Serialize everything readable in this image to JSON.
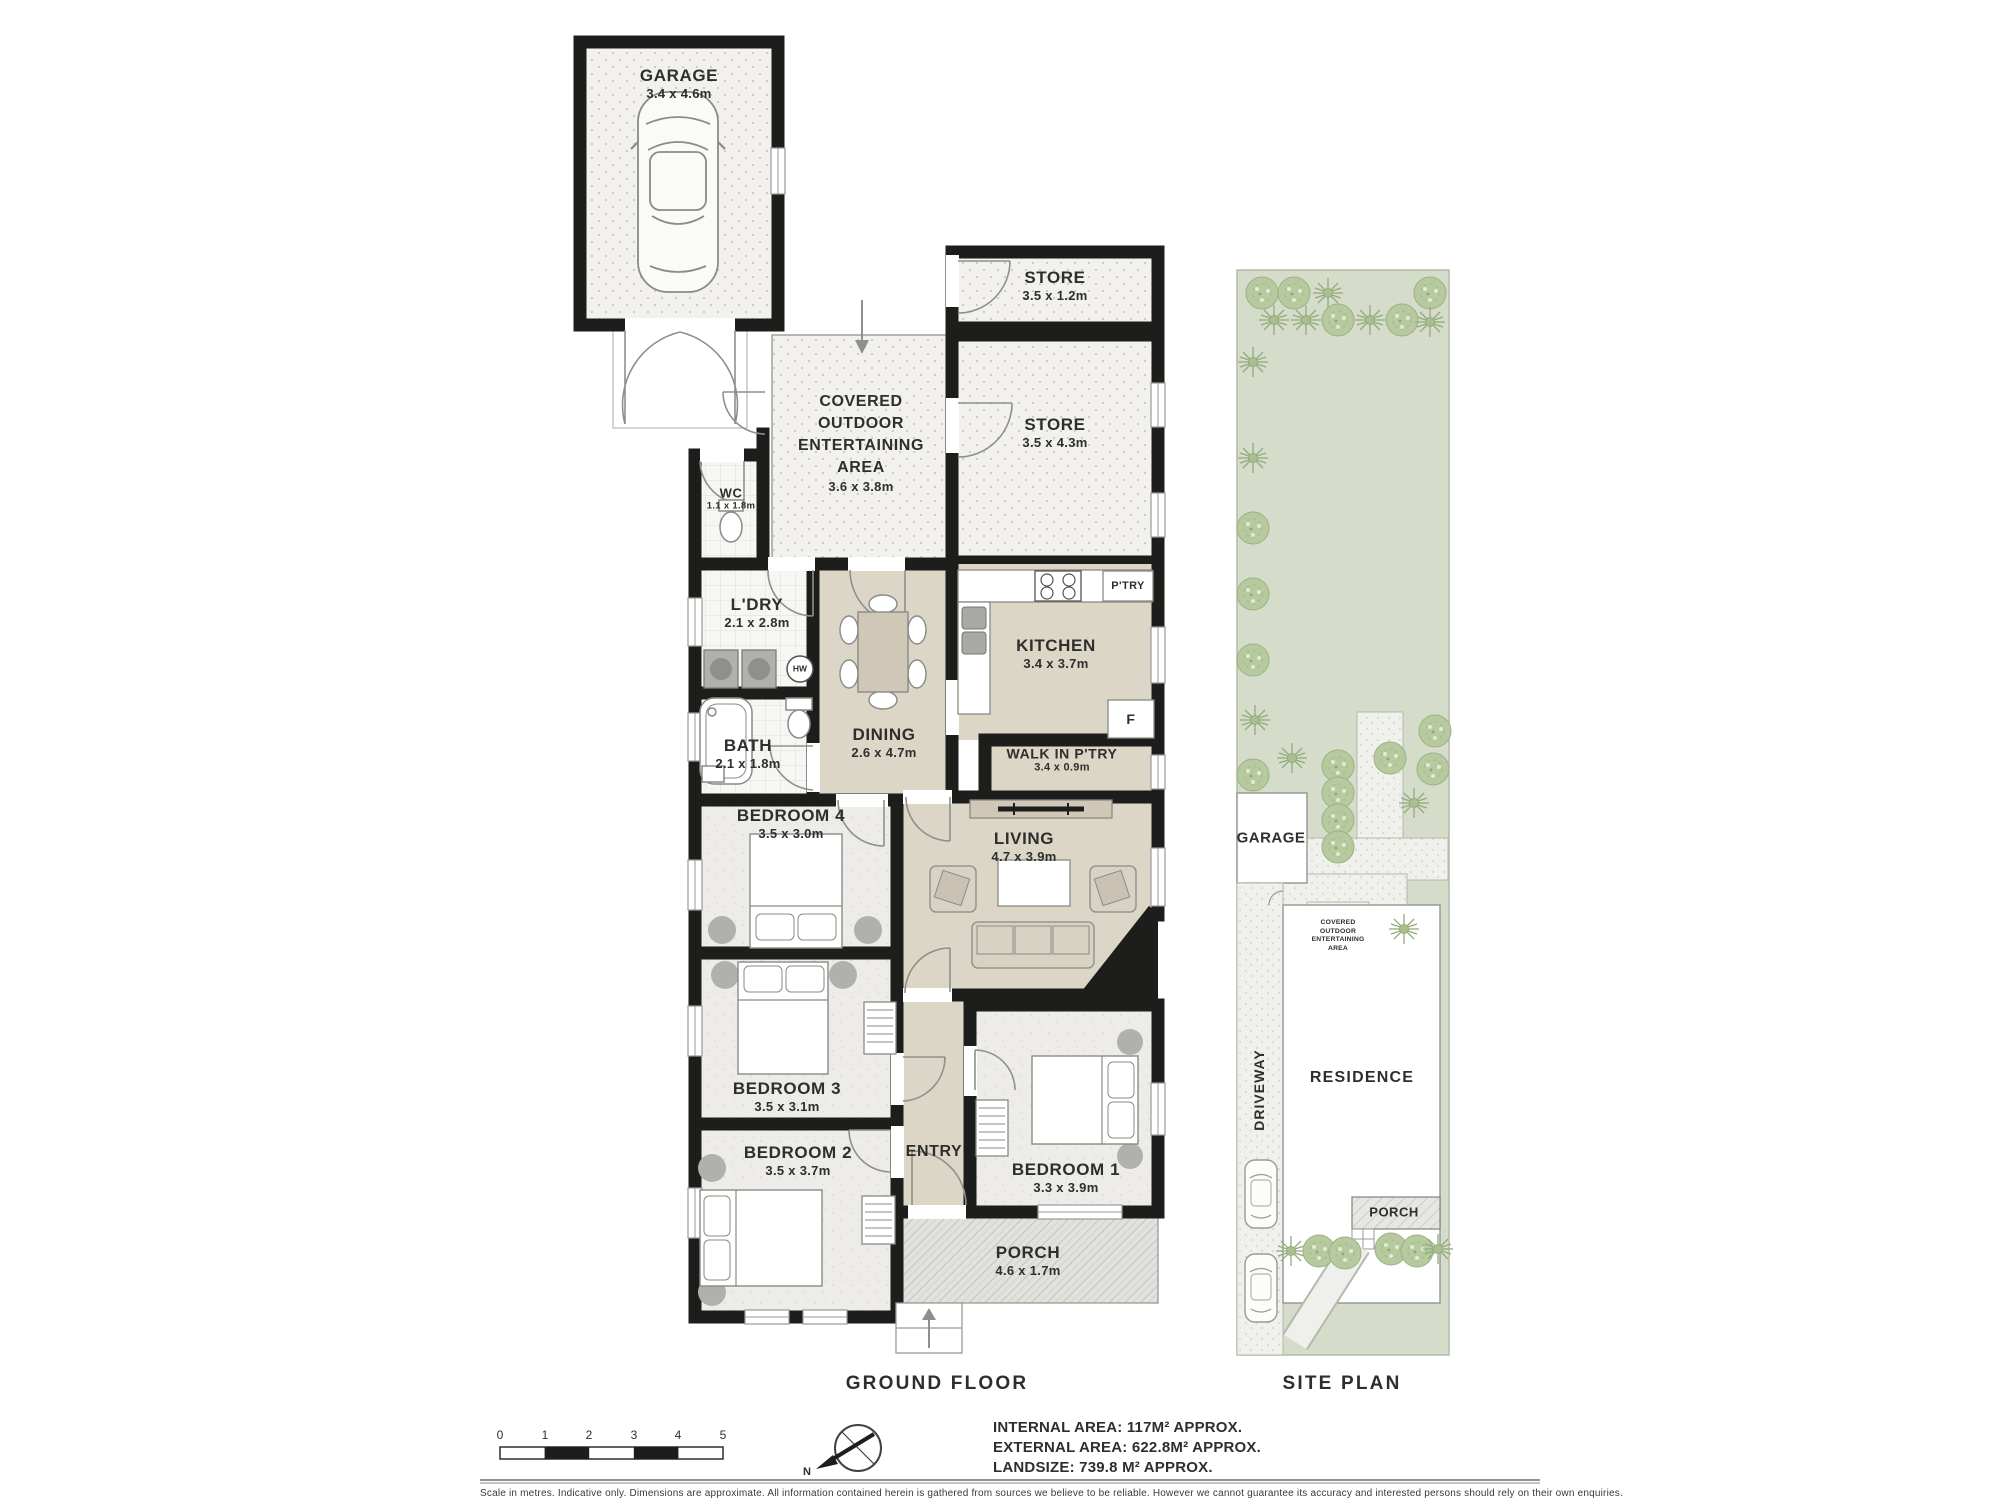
{
  "floor_plan": {
    "caption": "GROUND FLOOR",
    "rooms": {
      "garage": {
        "name": "GARAGE",
        "dims": "3.4 x 4.6m"
      },
      "store_small": {
        "name": "STORE",
        "dims": "3.5 x 1.2m"
      },
      "store_large": {
        "name": "STORE",
        "dims": "3.5 x 4.3m"
      },
      "outdoor_area": {
        "line1": "COVERED",
        "line2": "OUTDOOR",
        "line3": "ENTERTAINING",
        "line4": "AREA",
        "dims": "3.6 x 3.8m"
      },
      "wc": {
        "name": "WC",
        "dims": "1.1 x 1.8m"
      },
      "laundry": {
        "name": "L'DRY",
        "dims": "2.1 x 2.8m"
      },
      "bath": {
        "name": "BATH",
        "dims": "2.1 x 1.8m"
      },
      "dining": {
        "name": "DINING",
        "dims": "2.6 x 4.7m"
      },
      "kitchen": {
        "name": "KITCHEN",
        "dims": "3.4 x 3.7m"
      },
      "pantry": {
        "name": "P'TRY"
      },
      "fridge": {
        "name": "F"
      },
      "hot_water": {
        "name": "HW"
      },
      "walk_in_pantry": {
        "name": "WALK IN P'TRY",
        "dims": "3.4 x 0.9m"
      },
      "living": {
        "name": "LIVING",
        "dims": "4.7 x 3.9m"
      },
      "bedroom4": {
        "name": "BEDROOM 4",
        "dims": "3.5 x 3.0m"
      },
      "bedroom3": {
        "name": "BEDROOM 3",
        "dims": "3.5 x 3.1m"
      },
      "bedroom2": {
        "name": "BEDROOM 2",
        "dims": "3.5 x 3.7m"
      },
      "bedroom1": {
        "name": "BEDROOM 1",
        "dims": "3.3 x 3.9m"
      },
      "entry": {
        "name": "ENTRY"
      },
      "porch": {
        "name": "PORCH",
        "dims": "4.6 x 1.7m"
      }
    }
  },
  "site_plan": {
    "caption": "SITE PLAN",
    "labels": {
      "garage": "GARAGE",
      "driveway": "DRIVEWAY",
      "residence": "RESIDENCE",
      "outdoor_area": "COVERED OUTDOOR ENTERTAINING AREA",
      "porch": "PORCH"
    }
  },
  "legend": {
    "scale_ticks": [
      "0",
      "1",
      "2",
      "3",
      "4",
      "5"
    ],
    "compass_north": "N",
    "internal_area": "INTERNAL AREA: 117M² APPROX.",
    "external_area": "EXTERNAL AREA: 622.8M² APPROX.",
    "landsize": "LANDSIZE: 739.8 M² APPROX.",
    "disclaimer": "Scale in metres. Indicative only. Dimensions are approximate. All information contained herein is gathered from sources we believe to be reliable. However we cannot guarantee its accuracy and interested persons should rely on their own enquiries."
  }
}
